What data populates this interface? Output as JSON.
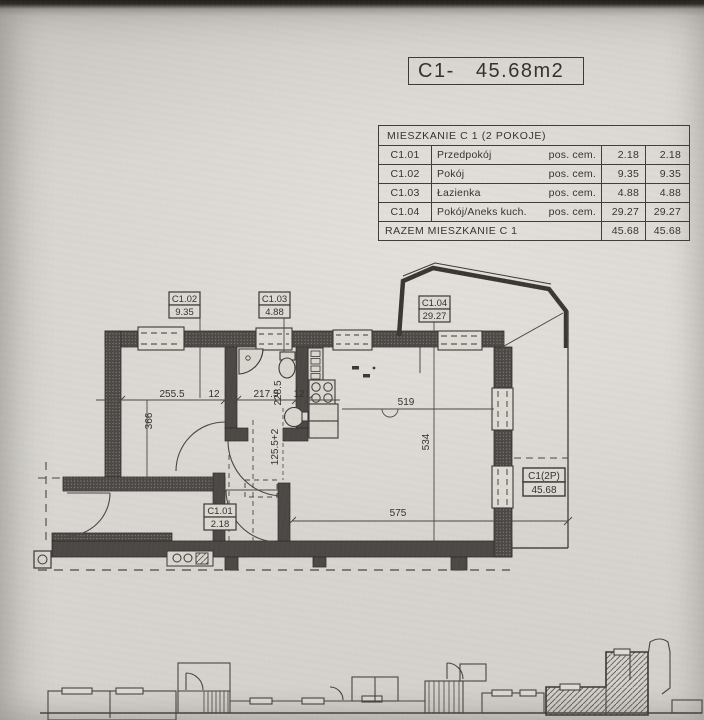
{
  "title": {
    "label": "C1-   45.68m2"
  },
  "summary_table": {
    "header": "MIESZKANIE C 1 (2 POKOJE)",
    "rows": [
      {
        "code": "C1.01",
        "name": "Przedpokój",
        "finish": "pos. cem.",
        "area1": "2.18",
        "area2": "2.18"
      },
      {
        "code": "C1.02",
        "name": "Pokój",
        "finish": "pos. cem.",
        "area1": "9.35",
        "area2": "9.35"
      },
      {
        "code": "C1.03",
        "name": "Łazienka",
        "finish": "pos. cem.",
        "area1": "4.88",
        "area2": "4.88"
      },
      {
        "code": "C1.04",
        "name": "Pokój/Aneks kuch.",
        "finish": "pos. cem.",
        "area1": "29.27",
        "area2": "29.27"
      }
    ],
    "total_label": "RAZEM MIESZKANIE C 1",
    "total1": "45.68",
    "total2": "45.68"
  },
  "plan": {
    "labels": {
      "c102": {
        "code": "C1.02",
        "area": "9.35"
      },
      "c103": {
        "code": "C1.03",
        "area": "4.88"
      },
      "c104": {
        "code": "C1.04",
        "area": "29.27"
      },
      "c101": {
        "code": "C1.01",
        "area": "2.18"
      },
      "unit": {
        "code": "C1(2P)",
        "area": "45.68"
      }
    },
    "dims": {
      "room_w": "255.5",
      "wall_a": "12",
      "bath_w": "217.5",
      "bath_h": "228.5",
      "wall_b": "12",
      "living_w": "519",
      "room_h": "366",
      "living_h": "534",
      "hall_h": "125.5+2",
      "bottom_w": "575"
    }
  },
  "colors": {
    "paper": "#d6d3ce",
    "ink": "#3a3835",
    "wall": "#4b4845"
  }
}
